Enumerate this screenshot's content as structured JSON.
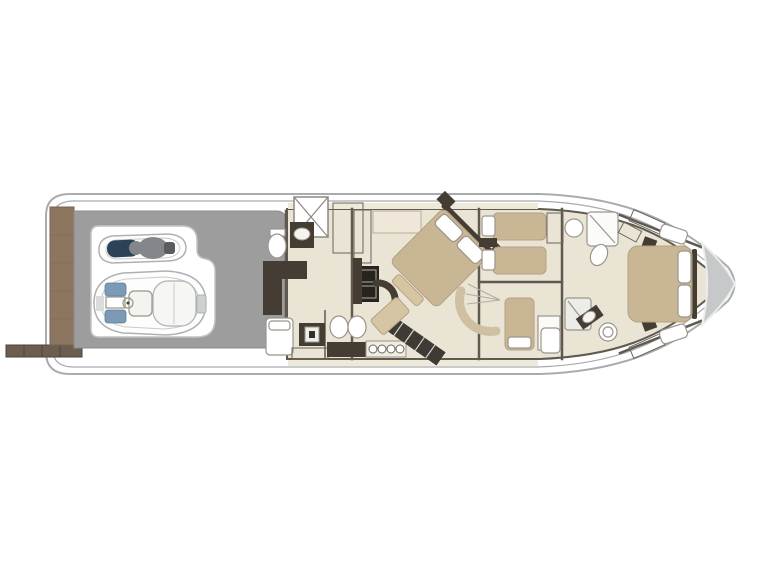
{
  "meta": {
    "title": "Motor yacht lower deck floor plan, top-down view, bow to the right",
    "view": "top-down",
    "bow_direction": "right",
    "background": "#ffffff",
    "visible_text": "none"
  },
  "colors": {
    "hull_fill": "#ffffff",
    "hull_line": "#a9abad",
    "deck_gray": "#9d9d9d",
    "teak": "#8c7660",
    "teak_line": "#77634f",
    "passerelle": "#6b5e51",
    "floor": "#eae4d5",
    "wall": "#5f5950",
    "furniture_dark": "#453d34",
    "bed_tan": "#c9b694",
    "bed_tan_dark": "#b5a181",
    "fixture_line": "#9a958c",
    "seat_navy": "#2c4257",
    "accent_blue": "#7b9ab5",
    "rider_gray": "#83878b",
    "bow_gray": "#c6c8c9",
    "stair_dark": "#3f3a33"
  },
  "vessel": {
    "stern": {
      "swim_platform": "teak swim platform",
      "passerelle": "gangway extended to port"
    },
    "garage": {
      "name": "tender garage",
      "contents": [
        "jet ski with rider",
        "RIB tender with center console and sunpad"
      ]
    },
    "crew_area": {
      "name": "crew cabin and utility",
      "items": [
        "engine room hatch",
        "aft staircase",
        "toilet",
        "vanity sink",
        "L-shaped sofa",
        "crew berth",
        "washer",
        "access steps"
      ]
    },
    "galley": {
      "name": "galley / lower lobby",
      "items": [
        "hanging locker",
        "cabinet",
        "oven column",
        "twin sink vanity",
        "four burner cooktop",
        "diagonal staircase",
        "curved bench",
        "vanity desk"
      ]
    },
    "master_cabin": {
      "name": "master cabin",
      "items": [
        "diagonal double bed",
        "two pillows",
        "headboard",
        "two nightstands",
        "foot bench",
        "tv cabinet"
      ]
    },
    "guest_cabin_twin": {
      "name": "twin guest cabin",
      "items": [
        "two single beds",
        "two pillows",
        "nightstand",
        "hanging locker"
      ]
    },
    "bathroom_forward": {
      "name": "forward guest bathroom",
      "items": [
        "round sink",
        "shower",
        "toilet",
        "hanging locker"
      ]
    },
    "guest_cabin_mid": {
      "name": "mid lower cabin",
      "items": [
        "single bed",
        "pillow",
        "curved sofa",
        "fan steps",
        "closet",
        "berth"
      ]
    },
    "bathroom_mid": {
      "name": "mid bathroom",
      "items": [
        "shower",
        "dark vanity with basin",
        "toilet"
      ]
    },
    "vip_cabin": {
      "name": "VIP bow cabin",
      "items": [
        "double bed",
        "two pillows",
        "headboard",
        "side benches",
        "nightstands",
        "hanging lockers"
      ]
    },
    "bow": {
      "anchor_locker": "gray bow locker triangle"
    }
  }
}
